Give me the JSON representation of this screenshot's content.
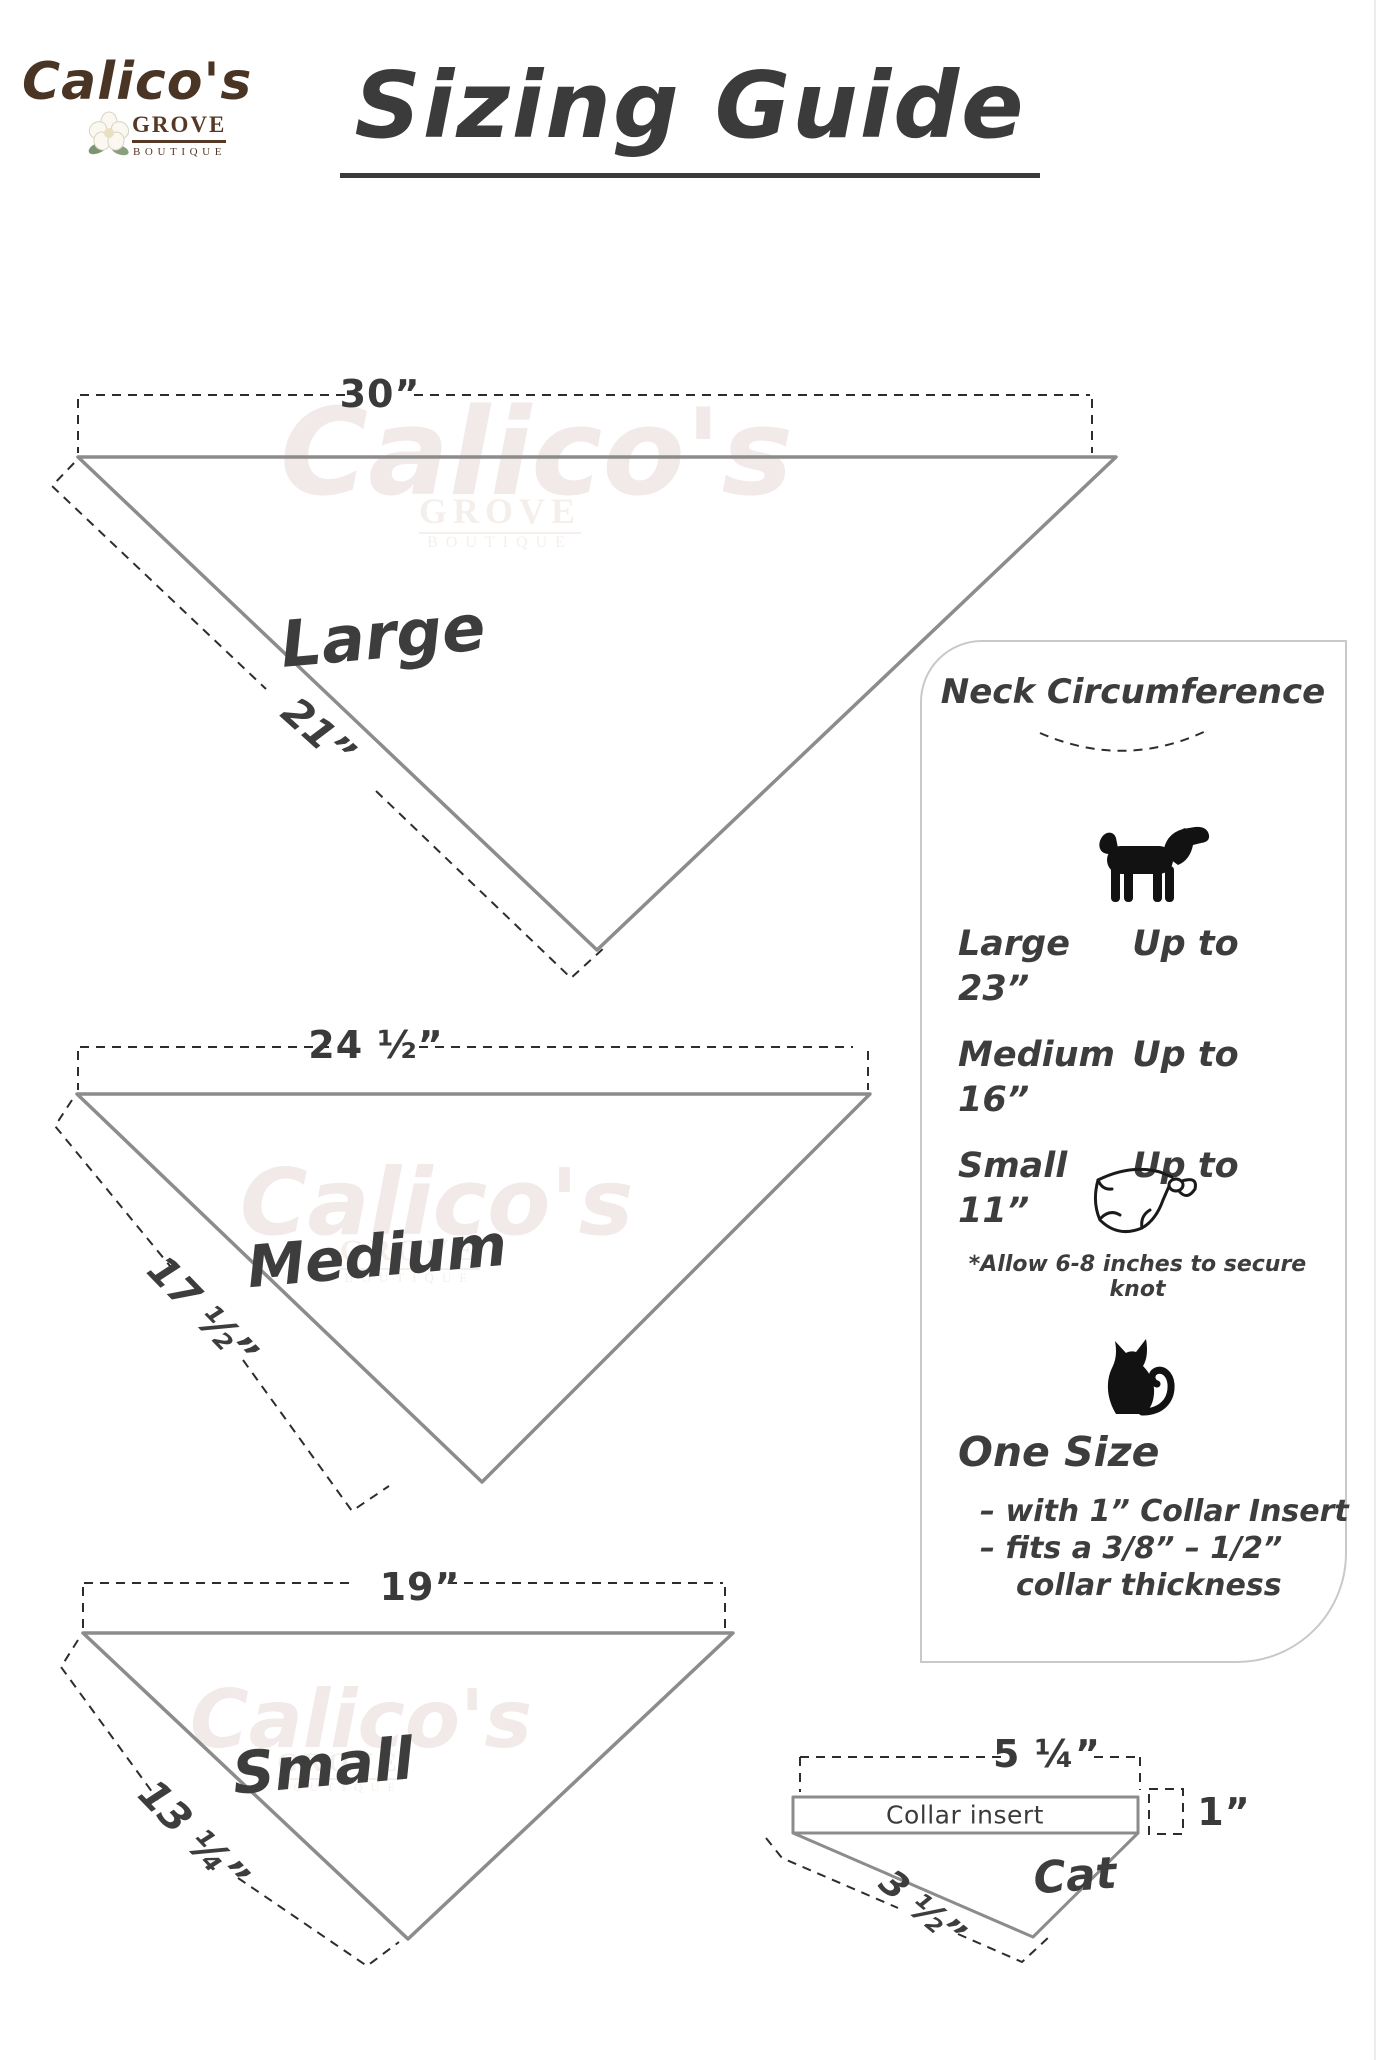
{
  "logo": {
    "name": "Calico's",
    "line2": "GROVE",
    "line3": "BOUTIQUE"
  },
  "title": "Sizing Guide",
  "watermark": {
    "script": "Calico's",
    "grove": "GROVE",
    "boutique": "BOUTIQUE"
  },
  "diagrams": {
    "large": {
      "label": "Large",
      "top_width": "30”",
      "side_length": "21”"
    },
    "medium": {
      "label": "Medium",
      "top_width": "24 ½”",
      "side_length": "17 ½”"
    },
    "small": {
      "label": "Small",
      "top_width": "19”",
      "side_length": "13 ¼”"
    }
  },
  "panel": {
    "title": "Neck Circumference",
    "dog_rows": [
      {
        "size": "Large",
        "fit": "Up to 23”"
      },
      {
        "size": "Medium",
        "fit": "Up to 16”"
      },
      {
        "size": "Small",
        "fit": "Up to 11”"
      }
    ],
    "knot_note": "*Allow 6-8 inches to secure knot",
    "cat_section": {
      "heading": "One Size",
      "bullet1": "– with 1” Collar Insert",
      "bullet2": "– fits a 3/8” – 1/2”",
      "bullet3": "collar thickness"
    }
  },
  "cat_diagram": {
    "label": "Cat",
    "collar_label": "Collar insert",
    "top_width": "5 ¼”",
    "insert_height": "1”",
    "side_length": "3 ½”"
  },
  "icons": {
    "flower": "flower-icon",
    "dog": "dog-icon",
    "bandana": "bandana-icon",
    "cat": "cat-icon"
  },
  "colors": {
    "brand_brown": "#4a3423",
    "text_dark": "#3b3b3b",
    "outline_gray": "#8c8c8c",
    "dash_dark": "#2d2d2d",
    "panel_border": "#c9c9c9",
    "watermark": "#f2e9e9"
  }
}
